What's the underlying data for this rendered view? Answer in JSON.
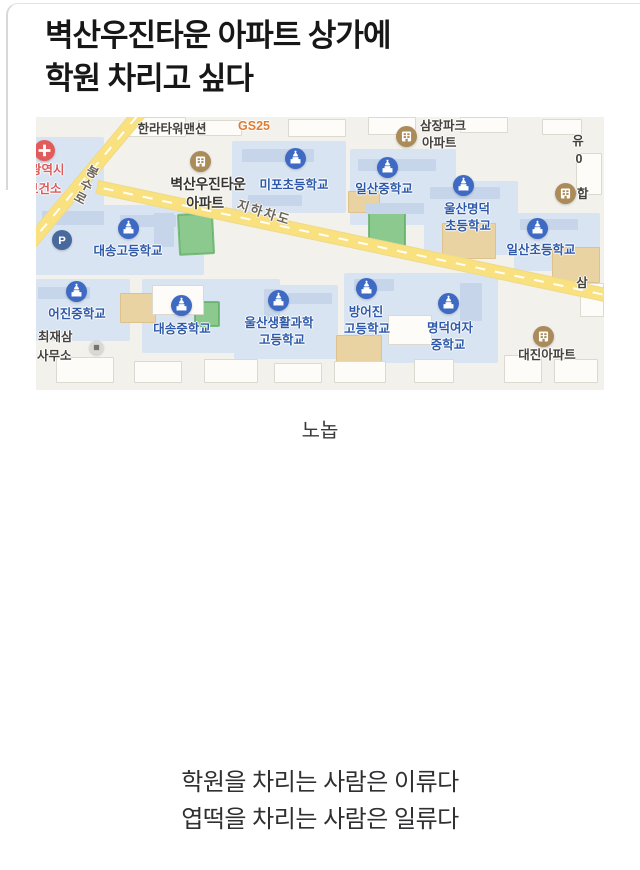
{
  "post": {
    "title_line1": "벽산우진타운 아파트 상가에",
    "title_line2": "학원 차리고 싶다",
    "caption": "노놉",
    "punchline_line1": "학원을 차리는 사람은 이류다",
    "punchline_line2": "엽떡을 차리는 사람은 일류다"
  },
  "map": {
    "colors": {
      "school_icon": "#3e6ac4",
      "school_label": "#2d59a8",
      "apartment_icon": "#aa8b59",
      "road_yellow": "#f9e17f",
      "campus_block": "#d9e4f2",
      "poi_dark": "#45423e",
      "gs25_orange": "#df7c34",
      "health_red": "#e25b5b",
      "field_green": "#8cc98f"
    },
    "pois": [
      {
        "id": "hanla-tower-mansion",
        "cls": "dark",
        "lines": [
          {
            "t": "한라타워맨션",
            "cx": 136,
            "y": 4
          }
        ]
      },
      {
        "id": "gs25",
        "cls": "orange",
        "lines": [
          {
            "t": "GS25",
            "cx": 218,
            "y": 1
          }
        ]
      },
      {
        "id": "samjang-park-apt",
        "icon": "apartment",
        "ix": 370,
        "iy": 19,
        "cls": "dark",
        "lines": [
          {
            "t": "삼장파크",
            "x": 384,
            "y": 1
          },
          {
            "t": "아파트",
            "x": 386,
            "y": 18
          }
        ]
      },
      {
        "id": "yu-partial",
        "cls": "dark",
        "lines": [
          {
            "t": "유",
            "cx": 542,
            "y": 16
          },
          {
            "t": "0",
            "cx": 543,
            "y": 34
          }
        ]
      },
      {
        "id": "health-center",
        "icon": "health",
        "ix": 8,
        "iy": 33,
        "cls": "red",
        "lines": [
          {
            "t": "광역시",
            "x": -6,
            "y": 45
          },
          {
            "t": "보건소",
            "x": -9,
            "y": 64
          }
        ]
      },
      {
        "id": "byeoksan-woojin-town-apt",
        "icon": "apartment",
        "ix": 164,
        "iy": 44,
        "cls": "dark big",
        "lines": [
          {
            "t": "벽산우진타운",
            "cx": 172,
            "y": 59
          },
          {
            "t": "아파트",
            "cx": 169,
            "y": 78
          }
        ]
      },
      {
        "id": "mipo-elementary",
        "icon": "school",
        "ix": 259,
        "iy": 41,
        "cls": "school",
        "lines": [
          {
            "t": "미포초등학교",
            "cx": 258,
            "y": 60
          }
        ]
      },
      {
        "id": "ilsan-middle",
        "icon": "school",
        "ix": 351,
        "iy": 50,
        "cls": "school",
        "lines": [
          {
            "t": "일산중학교",
            "cx": 348,
            "y": 64
          }
        ]
      },
      {
        "id": "ulsan-myeongdeok-elementary",
        "icon": "school",
        "ix": 427,
        "iy": 68,
        "cls": "school",
        "lines": [
          {
            "t": "울산명덕",
            "cx": 431,
            "y": 84
          },
          {
            "t": "초등학교",
            "cx": 432,
            "y": 101
          }
        ]
      },
      {
        "id": "hap-apt-partial",
        "icon": "apartment",
        "ix": 529,
        "iy": 76,
        "cls": "dark",
        "lines": [
          {
            "t": "합",
            "x": 541,
            "y": 69
          }
        ]
      },
      {
        "id": "bongsu-ro",
        "cls": "road",
        "lines": [
          {
            "t": "봉",
            "cx": 57,
            "y": 48,
            "rot": 28
          },
          {
            "t": "수",
            "cx": 51,
            "y": 61,
            "rot": 28
          },
          {
            "t": "로",
            "cx": 45,
            "y": 74,
            "rot": 28
          }
        ]
      },
      {
        "id": "jiha-chado",
        "cls": "road",
        "lines": [
          {
            "t": "지하차도",
            "cx": 228,
            "y": 88,
            "rot": 17
          }
        ]
      },
      {
        "id": "parking",
        "icon": "parking",
        "ix": 26,
        "iy": 123,
        "is": 20,
        "lines": []
      },
      {
        "id": "daesong-high",
        "icon": "school",
        "ix": 92,
        "iy": 111,
        "cls": "school",
        "lines": [
          {
            "t": "대송고등학교",
            "cx": 92,
            "y": 126
          }
        ]
      },
      {
        "id": "ilsan-elementary",
        "icon": "school",
        "ix": 501,
        "iy": 111,
        "cls": "school",
        "lines": [
          {
            "t": "일산초등학교",
            "cx": 505,
            "y": 125
          }
        ]
      },
      {
        "id": "sam-partial",
        "cls": "dark",
        "lines": [
          {
            "t": "삼",
            "cx": 546,
            "y": 158
          }
        ]
      },
      {
        "id": "eojin-middle",
        "icon": "school",
        "ix": 40,
        "iy": 174,
        "cls": "school",
        "lines": [
          {
            "t": "어진중학교",
            "cx": 41,
            "y": 189
          }
        ]
      },
      {
        "id": "daesong-middle",
        "icon": "school",
        "ix": 145,
        "iy": 188,
        "cls": "school",
        "lines": [
          {
            "t": "대송중학교",
            "cx": 146,
            "y": 204
          }
        ]
      },
      {
        "id": "ulsan-life-science-high",
        "icon": "school",
        "ix": 242,
        "iy": 183,
        "cls": "school",
        "lines": [
          {
            "t": "울산생활과학",
            "cx": 243,
            "y": 198
          },
          {
            "t": "고등학교",
            "cx": 246,
            "y": 215
          }
        ]
      },
      {
        "id": "bangeojin-high",
        "icon": "school",
        "ix": 330,
        "iy": 171,
        "cls": "school",
        "lines": [
          {
            "t": "방어진",
            "cx": 330,
            "y": 187
          },
          {
            "t": "고등학교",
            "cx": 331,
            "y": 204
          }
        ]
      },
      {
        "id": "myeongdeok-girls-middle",
        "icon": "school",
        "ix": 412,
        "iy": 186,
        "cls": "school",
        "lines": [
          {
            "t": "명덕여자",
            "cx": 414,
            "y": 203
          },
          {
            "t": "중학교",
            "cx": 412,
            "y": 220
          }
        ]
      },
      {
        "id": "daejin-apt",
        "icon": "apartment",
        "ix": 507,
        "iy": 219,
        "cls": "dark",
        "lines": [
          {
            "t": "대진아파트",
            "cx": 511,
            "y": 230
          }
        ]
      },
      {
        "id": "choi-jaesam-office",
        "icon": "office",
        "ix": 60,
        "iy": 230,
        "is": 15,
        "cls": "dark",
        "lines": [
          {
            "t": "최재삼",
            "x": 2,
            "y": 212
          },
          {
            "t": "사무소",
            "x": 1,
            "y": 231
          }
        ]
      }
    ]
  }
}
